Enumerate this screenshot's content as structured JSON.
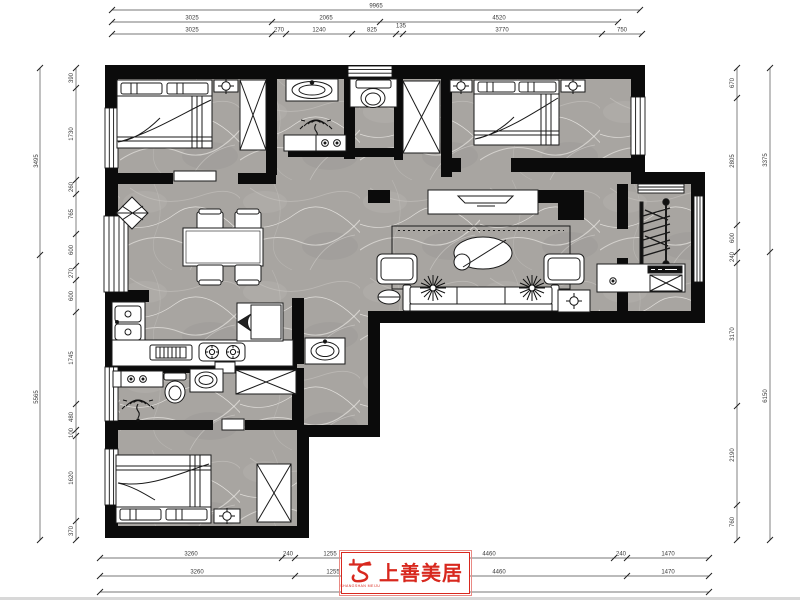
{
  "logo": {
    "title": "上善美居",
    "subtitle": "SHANGSHAN MEIJU"
  },
  "colors": {
    "wall": "#0b0b0b",
    "floor_base": "#a8a5a1",
    "dimension": "#3a3a3a",
    "logo_red": "#d8281e"
  },
  "dimensions": {
    "top": {
      "total": "9965",
      "row2": [
        "3025",
        "2065",
        "4520"
      ],
      "row3": [
        "3025",
        "270",
        "1240",
        "825",
        "135",
        "3770",
        "750"
      ]
    },
    "bottom": {
      "row1": [
        "3260",
        "240",
        "1255",
        "4460",
        "240",
        "1470"
      ],
      "row2": [
        "3260",
        "1255",
        "4460",
        "1470"
      ],
      "total": "10925"
    },
    "left": {
      "outer": [
        "3495",
        "5565"
      ],
      "inner": [
        "390",
        "1730",
        "260",
        "765",
        "600",
        "270",
        "600",
        "1745",
        "480",
        "100",
        "1620",
        "370"
      ]
    },
    "right": {
      "outer": [
        "3375",
        "6150"
      ],
      "inner": [
        "670",
        "2805",
        "600",
        "240",
        "3170",
        "2190",
        "760"
      ]
    }
  }
}
